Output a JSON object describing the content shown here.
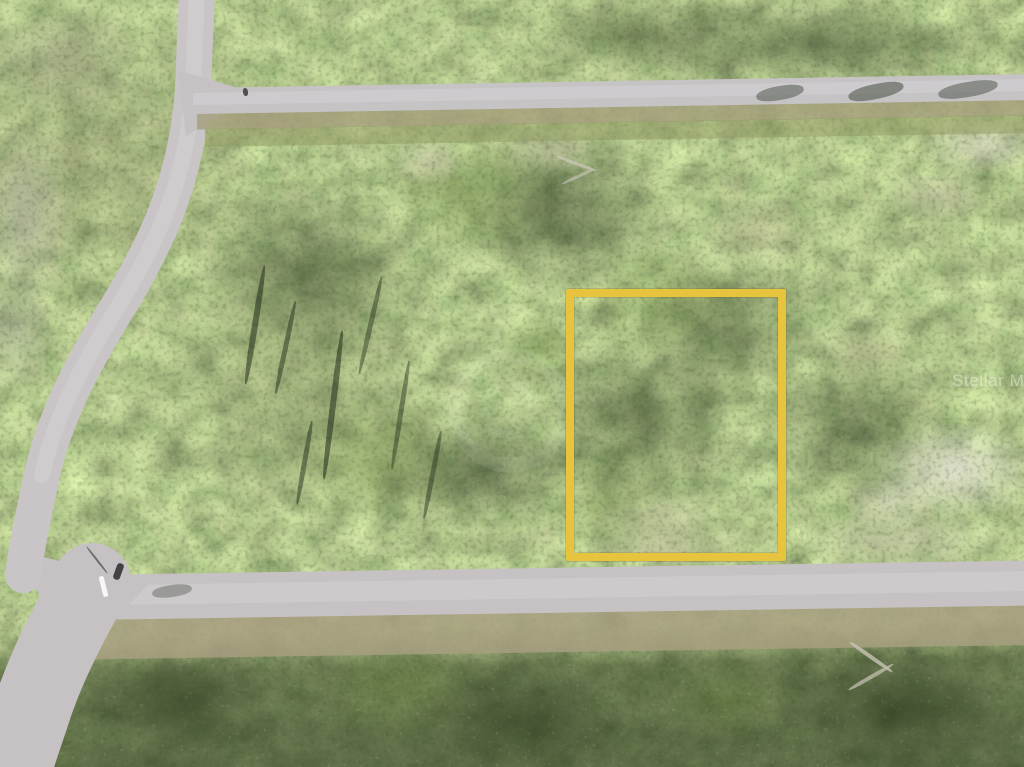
{
  "watermark": {
    "text": "Stellar MLS"
  },
  "property_highlight": {
    "shape": "rectangle-outline",
    "color": "#e8c33e",
    "x": 566,
    "y": 289,
    "width": 220,
    "height": 272,
    "stroke_px": 8
  },
  "scene": {
    "roads": [
      "upper-horizontal-road",
      "left-diagonal-road",
      "lower-horizontal-road"
    ],
    "road_markings": [
      "white-dash-near-lower-intersection"
    ]
  },
  "palette": {
    "vegetation_green": "#75944a",
    "dark_canopy": "#2a381c",
    "dry_grass_tan": "#a89f7e",
    "sand_white": "#dedbcf",
    "pavement_gray": "#c6c2c4",
    "highlight_yellow": "#e8c33e",
    "watermark_white": "rgba(255,255,255,0.42)"
  }
}
